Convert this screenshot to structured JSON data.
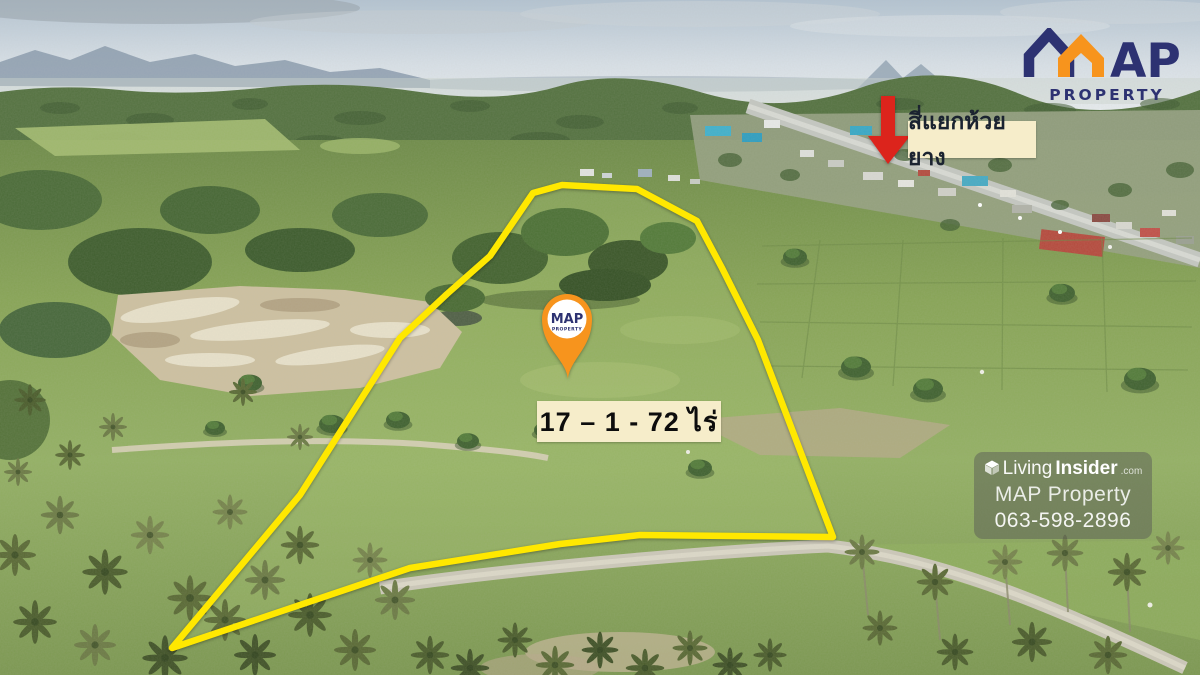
{
  "logo": {
    "wordmark": "MAP",
    "wordmark_tail": "AP",
    "tagline": "PROPERTY"
  },
  "pin_logo": {
    "wordmark": "MAP",
    "tagline": "PROPERTY"
  },
  "annotations": {
    "junction_label": "สี่แยกห้วยยาง",
    "area_label": "17 – 1 - 72 ไร่"
  },
  "watermark": {
    "brand_light": "Living",
    "brand_bold": "Insider",
    "brand_suffix": ".com",
    "company": "MAP Property",
    "phone": "063-598-2896"
  },
  "colors": {
    "boundary_yellow": "#FFE800",
    "brand_navy": "#2D3272",
    "brand_orange": "#F7941D",
    "arrow_red": "#DC241C",
    "label_background": "#F6EDCA"
  }
}
